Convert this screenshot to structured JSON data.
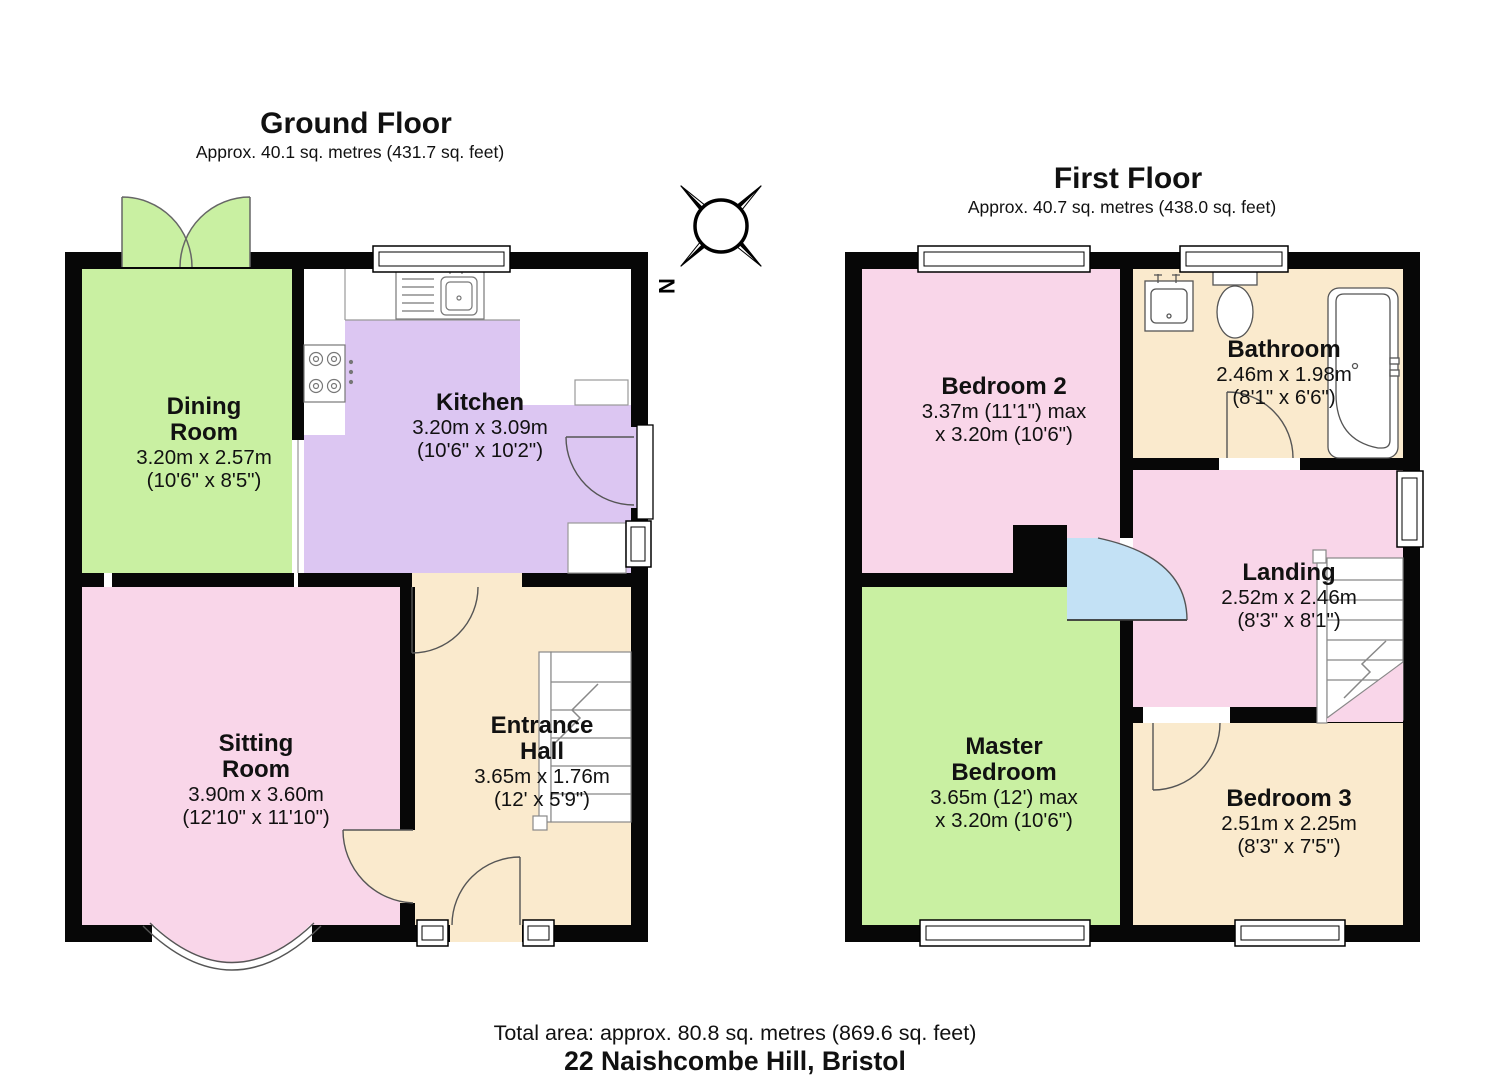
{
  "ground_floor": {
    "title": "Ground Floor",
    "subtitle": "Approx. 40.1 sq. metres (431.7 sq. feet)",
    "rooms": {
      "dining": {
        "name": "Dining Room",
        "dims_metric": "3.20m x 2.57m",
        "dims_imperial": "(10'6\" x 8'5\")"
      },
      "kitchen": {
        "name": "Kitchen",
        "dims_metric": "3.20m x 3.09m",
        "dims_imperial": "(10'6\" x 10'2\")"
      },
      "sitting": {
        "name": "Sitting Room",
        "dims_metric": "3.90m x 3.60m",
        "dims_imperial": "(12'10\" x 11'10\")"
      },
      "entrance": {
        "name": "Entrance Hall",
        "dims_metric": "3.65m x 1.76m",
        "dims_imperial": "(12' x 5'9\")"
      }
    }
  },
  "first_floor": {
    "title": "First Floor",
    "subtitle": "Approx. 40.7 sq. metres (438.0 sq. feet)",
    "rooms": {
      "bedroom2": {
        "name": "Bedroom 2",
        "dims_metric": "3.37m (11'1\") max",
        "dims_imperial": "x 3.20m (10'6\")"
      },
      "bathroom": {
        "name": "Bathroom",
        "dims_metric": "2.46m x 1.98m",
        "dims_imperial": "(8'1\" x 6'6\")"
      },
      "landing": {
        "name": "Landing",
        "dims_metric": "2.52m x 2.46m",
        "dims_imperial": "(8'3\" x 8'1\")"
      },
      "master": {
        "name": "Master Bedroom",
        "dims_metric": "3.65m (12') max",
        "dims_imperial": "x 3.20m (10'6\")"
      },
      "bedroom3": {
        "name": "Bedroom 3",
        "dims_metric": "2.51m x 2.25m",
        "dims_imperial": "(8'3\" x 7'5\")"
      }
    }
  },
  "compass": {
    "north_label": "N"
  },
  "footer": {
    "total_area": "Total area: approx. 80.8 sq. metres (869.6 sq. feet)",
    "address": "22 Naishcombe Hill, Bristol"
  },
  "colors": {
    "room_green": "#c9f0a2",
    "room_pink": "#f9d6e9",
    "room_purple": "#dcc6f2",
    "room_beige": "#faeacd",
    "door_blue": "#c3e1f5",
    "wall": "#070707"
  }
}
